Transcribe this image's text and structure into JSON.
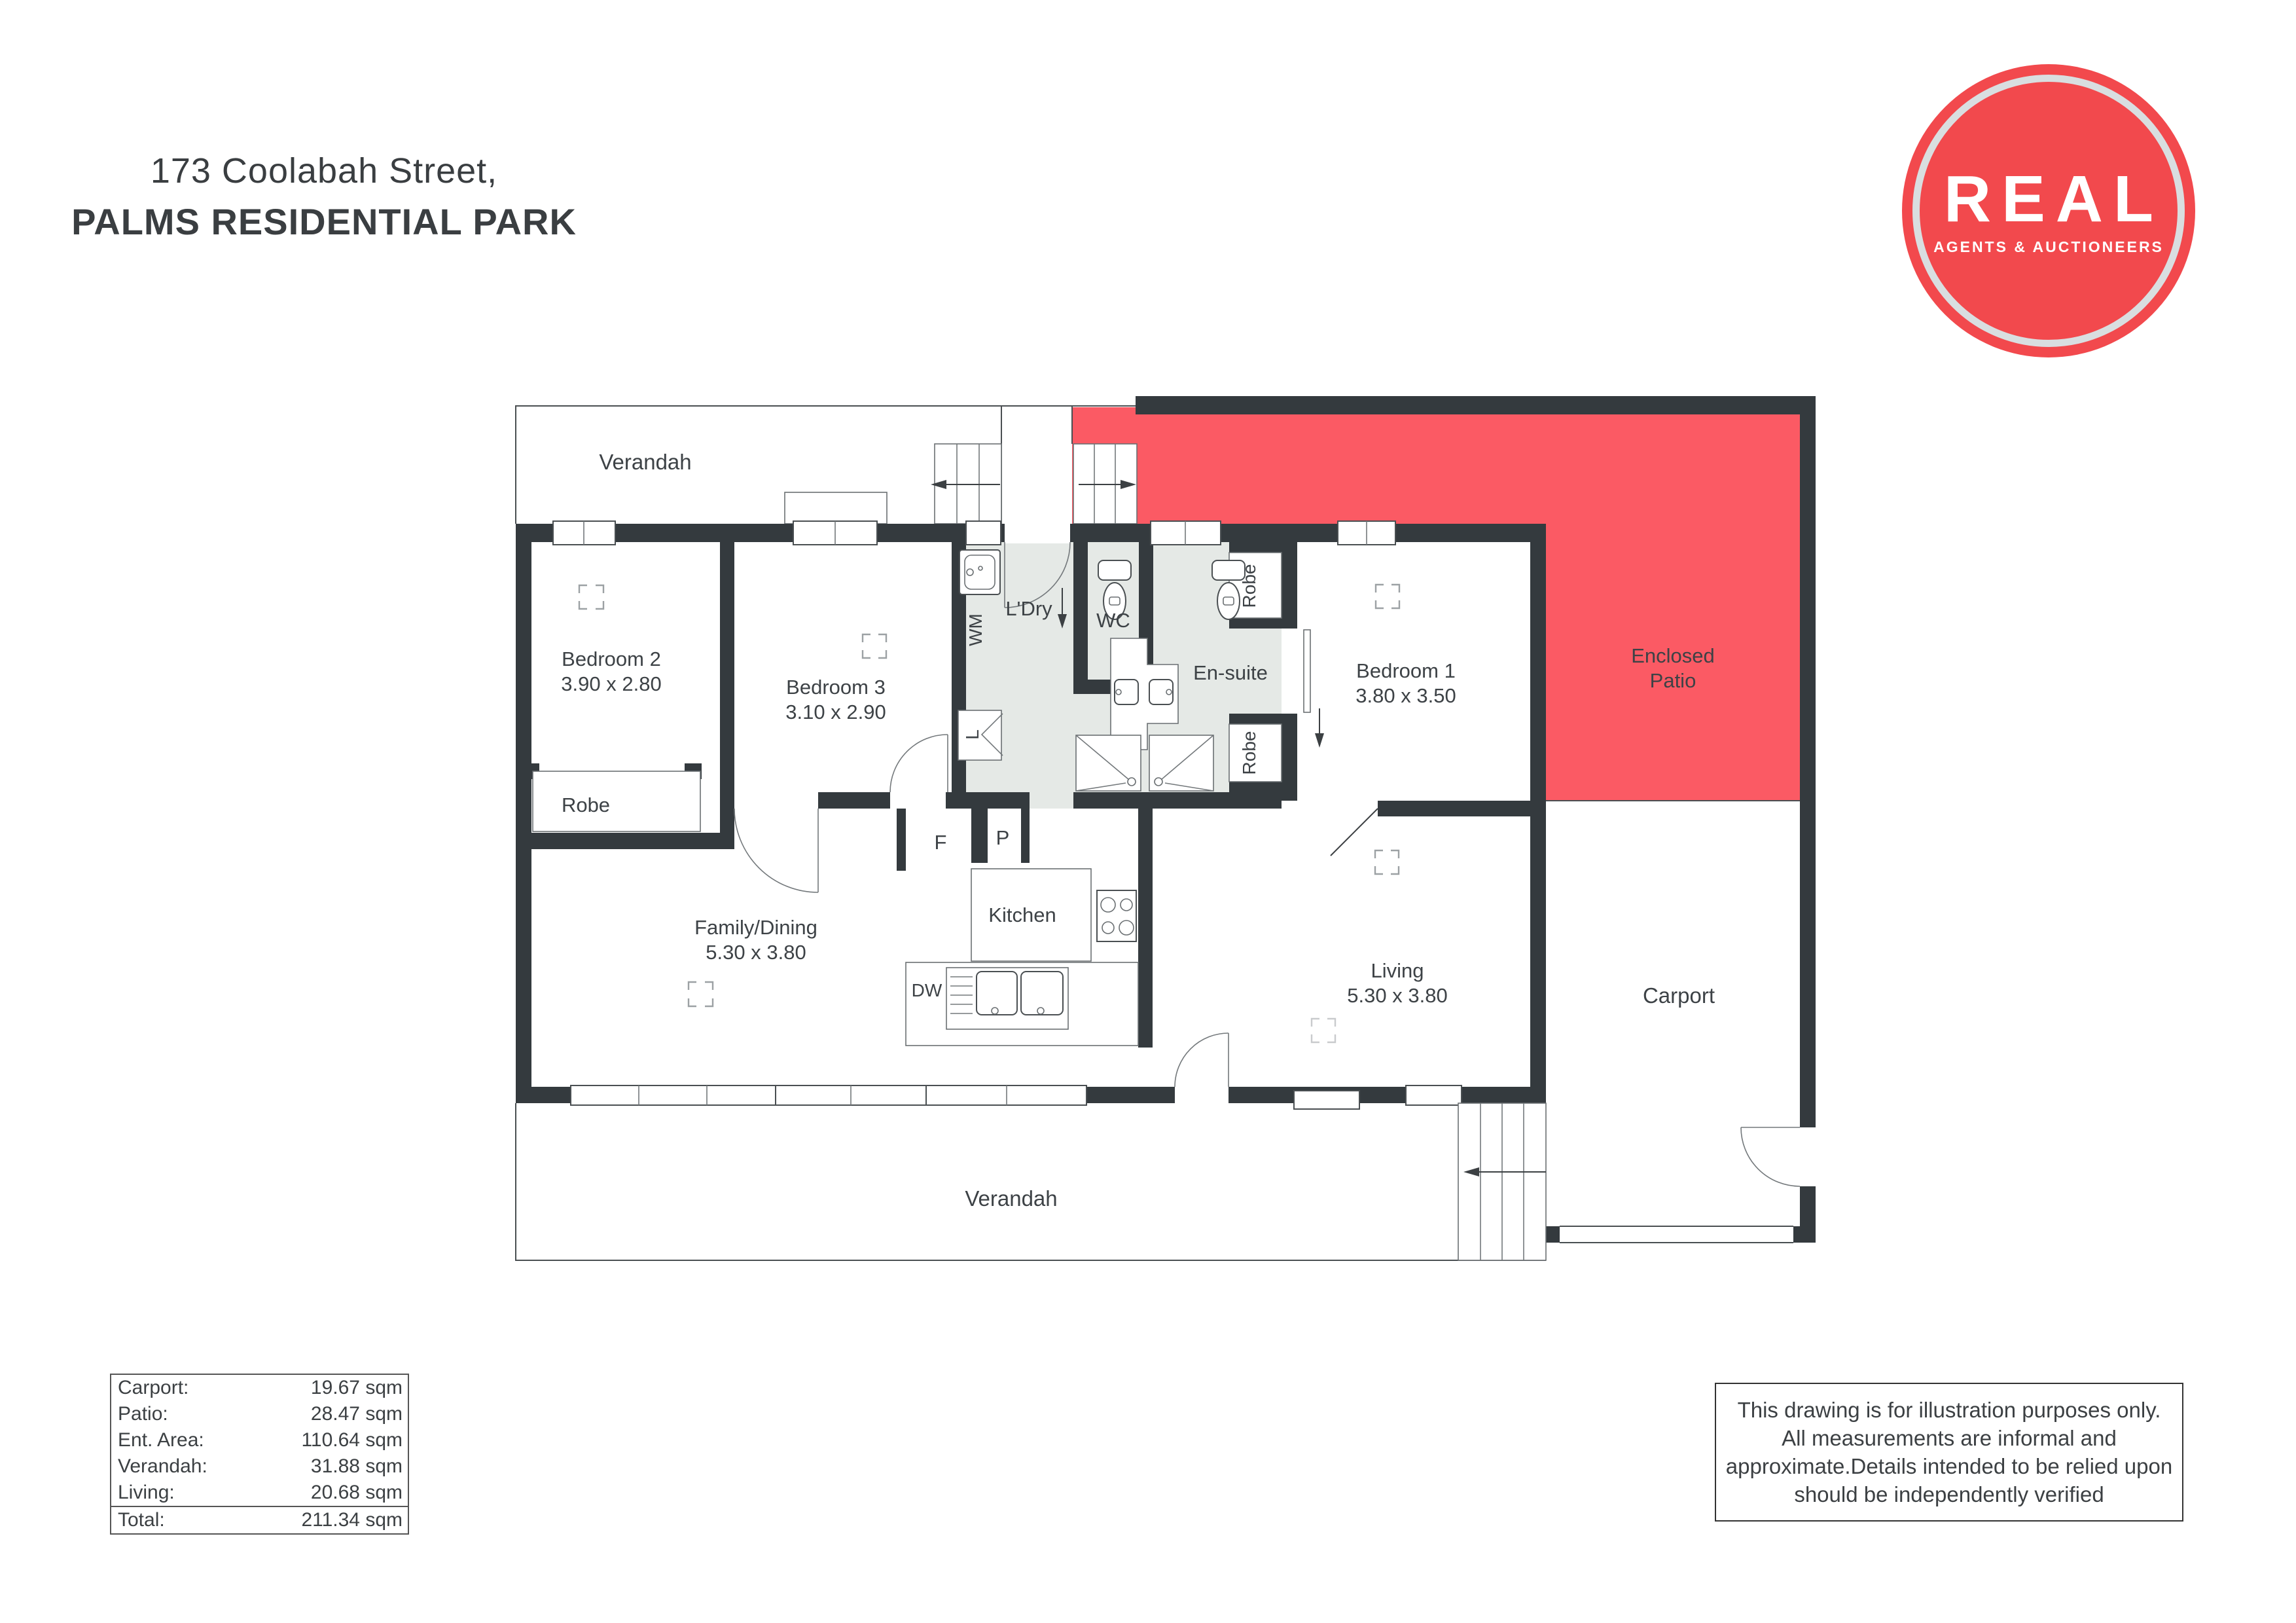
{
  "title": {
    "line1": "173 Coolabah Street,",
    "line2": "PALMS RESIDENTIAL PARK"
  },
  "logo": {
    "brand": "REAL",
    "tagline": "AGENTS & AUCTIONEERS",
    "circle_color": "#f2494d"
  },
  "colors": {
    "wall": "#343a3e",
    "patio_red": "#fb5a64",
    "wet_floor": "#e5e9e6",
    "label_text": "#3d4246"
  },
  "floorplan": {
    "labels": {
      "verandah_top": "Verandah",
      "verandah_bottom": "Verandah",
      "bedroom2": "Bedroom 2",
      "bedroom2_dims": "3.90 x 2.80",
      "bedroom3": "Bedroom 3",
      "bedroom3_dims": "3.10 x 2.90",
      "robe_bed2": "Robe",
      "ldry": "L'Dry",
      "wc": "WC",
      "ensuite": "En-suite",
      "robe_top": "Robe",
      "robe_bottom": "Robe",
      "bedroom1": "Bedroom 1",
      "bedroom1_dims": "3.80 x 3.50",
      "patio_line1": "Enclosed",
      "patio_line2": "Patio",
      "family": "Family/Dining",
      "family_dims": "5.30 x 3.80",
      "kitchen": "Kitchen",
      "living": "Living",
      "living_dims": "5.30 x 3.80",
      "carport": "Carport",
      "fridge": "F",
      "pantry": "P",
      "dishwasher": "DW",
      "washing_machine": "WM",
      "linen": "L"
    }
  },
  "area_table": {
    "rows": [
      {
        "label": "Carport:",
        "value": "19.67 sqm"
      },
      {
        "label": "Patio:",
        "value": "28.47 sqm"
      },
      {
        "label": "Ent. Area:",
        "value": "110.64 sqm"
      },
      {
        "label": "Verandah:",
        "value": "31.88 sqm"
      },
      {
        "label": "Living:",
        "value": "20.68 sqm"
      }
    ],
    "total": {
      "label": "Total:",
      "value": "211.34 sqm"
    }
  },
  "disclaimer": {
    "lines": [
      "This drawing is for illustration purposes only.",
      "All measurements are informal and",
      "approximate.Details intended to be relied upon",
      "should be independently verified"
    ]
  }
}
